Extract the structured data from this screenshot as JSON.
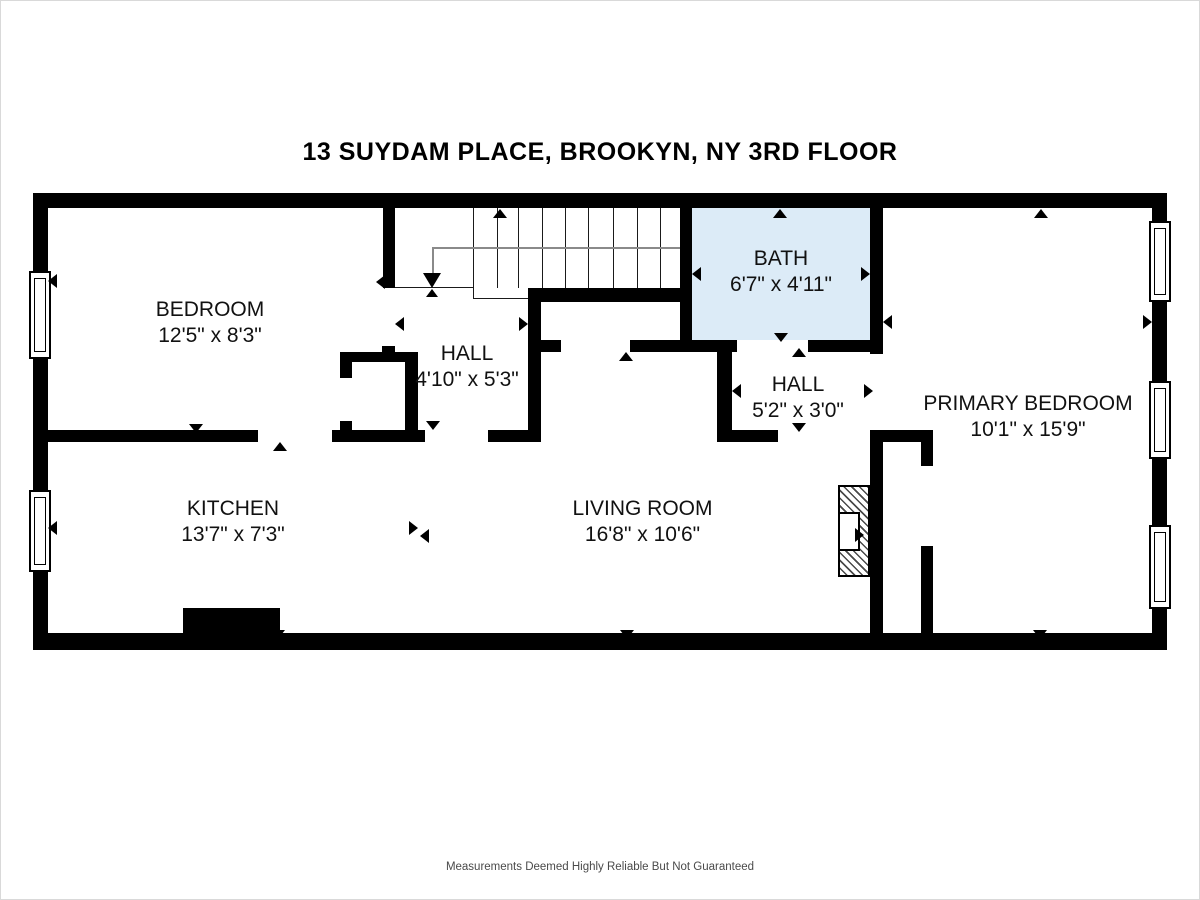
{
  "title": "13 SUYDAM PLACE, BROOKYN, NY 3RD FLOOR",
  "footer": "Measurements Deemed Highly Reliable But Not Guaranteed",
  "colors": {
    "wall": "#000000",
    "floor": "#ffffff",
    "bath_fill": "#dcebf7",
    "stair_direction_line": "#8a8a8a"
  },
  "rooms": [
    {
      "id": "bedroom",
      "name": "BEDROOM",
      "dims": "12'5\" x 8'3\""
    },
    {
      "id": "hall-upper",
      "name": "HALL",
      "dims": "4'10\" x 5'3\""
    },
    {
      "id": "bath",
      "name": "BATH",
      "dims": "6'7\" x 4'11\""
    },
    {
      "id": "hall-lower",
      "name": "HALL",
      "dims": "5'2\" x 3'0\""
    },
    {
      "id": "primary-bedroom",
      "name": "PRIMARY BEDROOM",
      "dims": "10'1\" x 15'9\""
    },
    {
      "id": "kitchen",
      "name": "KITCHEN",
      "dims": "13'7\" x 7'3\""
    },
    {
      "id": "living-room",
      "name": "LIVING ROOM",
      "dims": "16'8\" x 10'6\""
    }
  ]
}
